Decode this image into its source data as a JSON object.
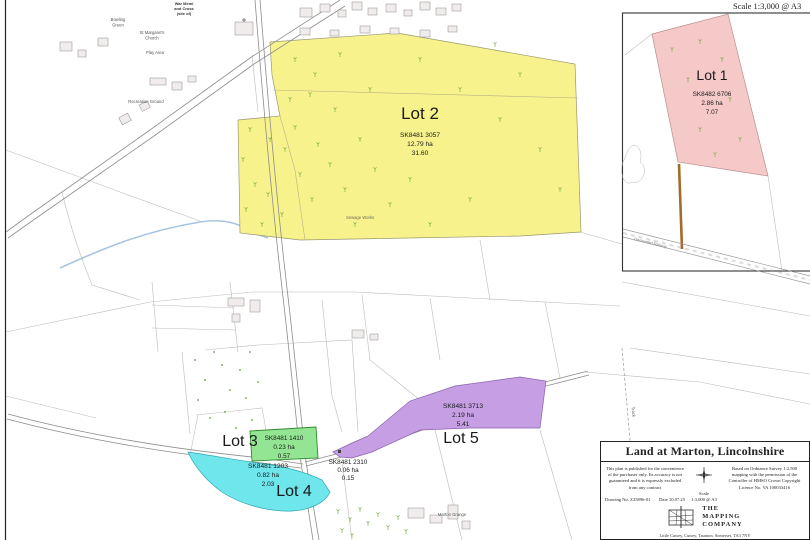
{
  "scale_note_top": "Scale 1:3,000 @ A3",
  "inset": {
    "lot1_name": "Lot 1",
    "lot1_ref": "SK8482 6706",
    "lot1_ha": "2.86 ha",
    "lot1_ac": "7.07",
    "railway_label": "Dismantled Railway"
  },
  "lots": {
    "lot2": {
      "name": "Lot 2",
      "ref": "SK8481 3057",
      "ha": "12.79 ha",
      "ac": "31.60"
    },
    "lot3": {
      "name": "Lot 3"
    },
    "lot4": {
      "name": "Lot 4",
      "ref": "SK8481 1203",
      "ha": "0.82 ha",
      "ac": "2.03"
    },
    "lot5": {
      "name": "Lot 5",
      "ref": "SK8481 3713",
      "ha": "2.19 ha",
      "ac": "5.41"
    },
    "paddock": {
      "ref": "SK8481 1410",
      "ha": "0.23 ha",
      "ac": "0.57"
    },
    "small": {
      "ref": "SK8481 2310",
      "ha": "0.06 ha",
      "ac": "0.15"
    }
  },
  "map_labels": {
    "bowling_green_1": "Bowling",
    "bowling_green_2": "Green",
    "church_1": "St Margaret's",
    "church_2": "Church",
    "meml_1": "War Meml",
    "meml_2": "and Cross",
    "meml_3": "(site of)",
    "play_area": "Play Area",
    "recreation_ground": "Recreation Ground",
    "sewage_works": "Sewage Works",
    "grange": "Marton Grange",
    "track": "Track"
  },
  "title_block": {
    "title": "Land at Marton, Lincolnshire",
    "disclaimer": "This plan is published for the convenience of the purchaser only. Its accuracy is not guaranteed and it is expressly excluded from any contract",
    "drawing_no": "Drawing No. Z25896-01",
    "date": "Date 10.07.25",
    "scale_word": "Scale",
    "scale_value": "1:3,000 @ A3",
    "os_credit": "Based on Ordnance Survey 1:2,500 mapping with the permission of the Controller of HMSO Crown Copyright Licence No. VA 100033416",
    "company_line1": "THE",
    "company_line2": "MAPPING",
    "company_line3": "COMPANY",
    "address": "Little Cutsey, Cutsey, Taunton, Somerset, TA3 7NY"
  },
  "colors": {
    "lot_yellow": "#F7F28C",
    "lot_pink": "#F6C9C9",
    "lot_purple": "#C69EE3",
    "lot_cyan": "#6FE5EC",
    "lot_green": "#93E593",
    "track_brown": "#A56A28",
    "stream_blue": "#A8C4E0"
  }
}
